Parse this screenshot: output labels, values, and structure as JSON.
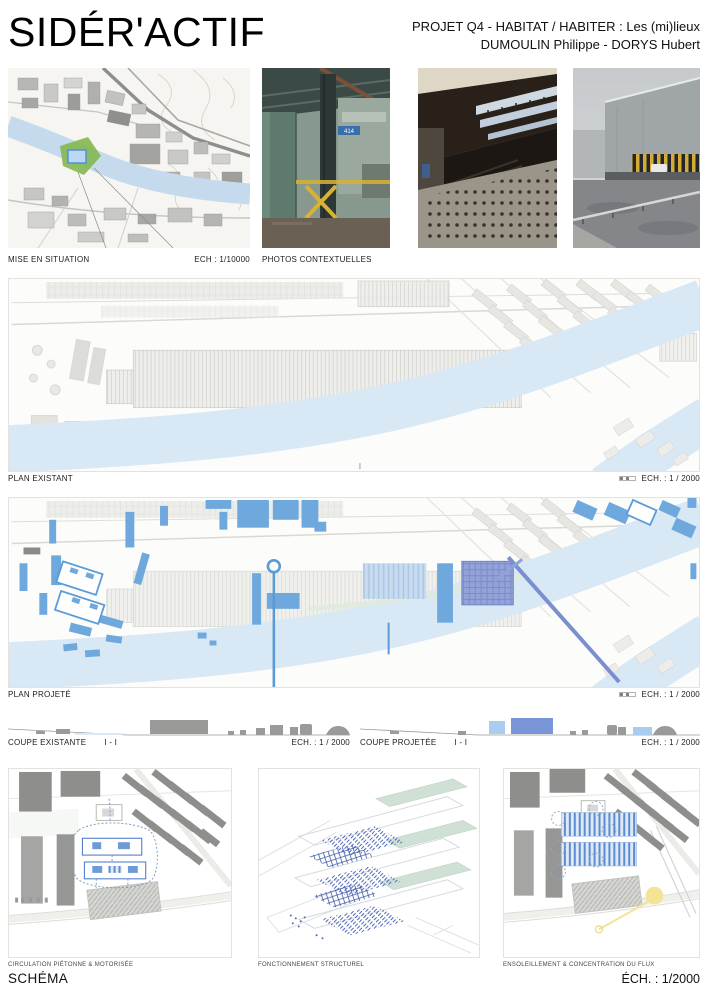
{
  "header": {
    "title": "SIDÉR'ACTIF",
    "project_line1": "PROJET Q4 - HABITAT / HABITER : Les (mi)lieux",
    "project_line2": "DUMOULIN Philippe - DORYS Hubert"
  },
  "row1": {
    "situation_label": "MISE EN SITUATION",
    "situation_scale": "ECH : 1/10000",
    "photos_label": "PHOTOS CONTEXTUELLES",
    "photo_sign": "414"
  },
  "plan_existant": {
    "label": "PLAN EXISTANT",
    "scale": "ECH. : 1 / 2000"
  },
  "plan_projete": {
    "label": "PLAN PROJETÉ",
    "scale": "ECH. : 1 / 2000"
  },
  "coupes": {
    "existante": {
      "label": "COUPE EXISTANTE",
      "mark": "I - I",
      "scale": "ECH. : 1 / 2000"
    },
    "projetee": {
      "label": "COUPE PROJETÉE",
      "mark": "I - I",
      "scale": "ECH. : 1 / 2000"
    }
  },
  "schemas": {
    "items": [
      {
        "label": "CIRCULATION PIÉTONNE & MOTORISÉE"
      },
      {
        "label": "FONCTIONNEMENT STRUCTUREL"
      },
      {
        "label": "ENSOLEILLEMENT & CONCENTRATION DU FLUX"
      }
    ],
    "footer_label": "SCHÉMA",
    "footer_scale": "ÉCH. : 1/2000"
  },
  "colors": {
    "project_blue": "#6fa8dc",
    "outline_blue": "#5b9bd5",
    "accent_violet": "#8191d0",
    "river_blue": "#d9e8f5",
    "site_green": "#84b954",
    "pale_green": "#cfe0d4",
    "sun_yellow": "#f3e394"
  }
}
